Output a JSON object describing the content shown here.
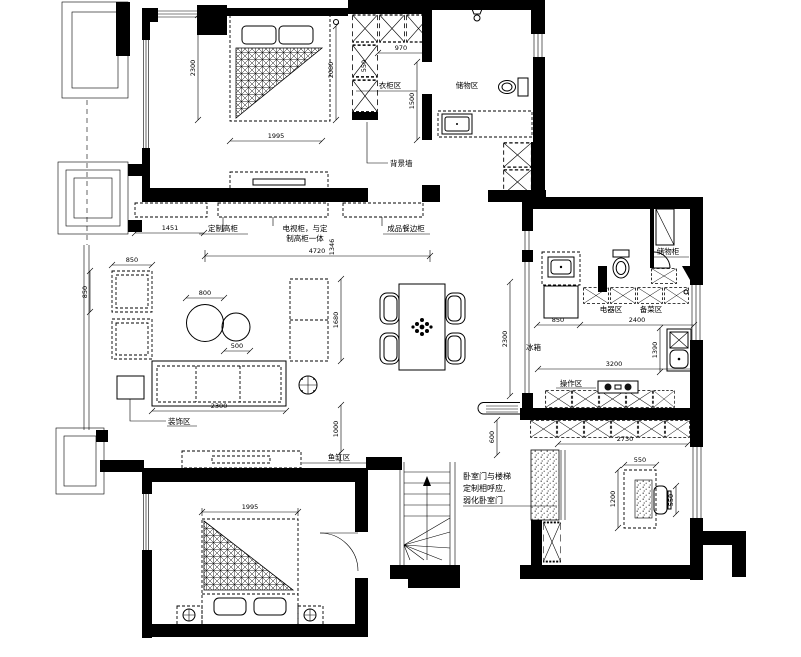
{
  "labels": {
    "wardrobe_area": "衣柜区",
    "storage_area": "储物区",
    "background_wall": "背景墙",
    "custom_tall_cabinet": "定制高柜",
    "tv_cabinet_line1": "电视柜，与定",
    "tv_cabinet_line2": "制高柜一体",
    "sideboard": "成品餐边柜",
    "decor_area": "装饰区",
    "fish_tank_area": "鱼缸区",
    "fridge": "冰箱",
    "appliance_area": "电器区",
    "prep_area": "备菜区",
    "cooking_area": "操作区",
    "storage_cabinet": "储物柜",
    "note_line1": "卧室门与楼梯",
    "note_line2": "定制相呼应,",
    "note_line3": "弱化卧室门"
  },
  "dims": {
    "bedroom1_depth": "2300",
    "bedroom1_bed_width": "1995",
    "bedroom1_bed_length": "2080",
    "wardrobe_width": "970",
    "wardrobe_side": "550",
    "wardrobe_depth": "1500",
    "cabinet_offset": "1451",
    "living_width": "4720",
    "living_offset": "1346",
    "armchair_width": "850",
    "armchair_depth": "850",
    "coffee_table": "800",
    "side_table": "500",
    "sofa_length": "2300",
    "tv_cabinet_length": "1680",
    "walkway": "1000",
    "dining_depth": "2300",
    "fridge_width": "850",
    "counter_length": "2400",
    "kitchen_width": "3200",
    "island_length": "1390",
    "door_offset": "600",
    "wardrobe2_width": "2730",
    "desk_width": "550",
    "desk_length": "1200",
    "desk_chair": "550",
    "bedroom3_bed_width": "1995"
  }
}
